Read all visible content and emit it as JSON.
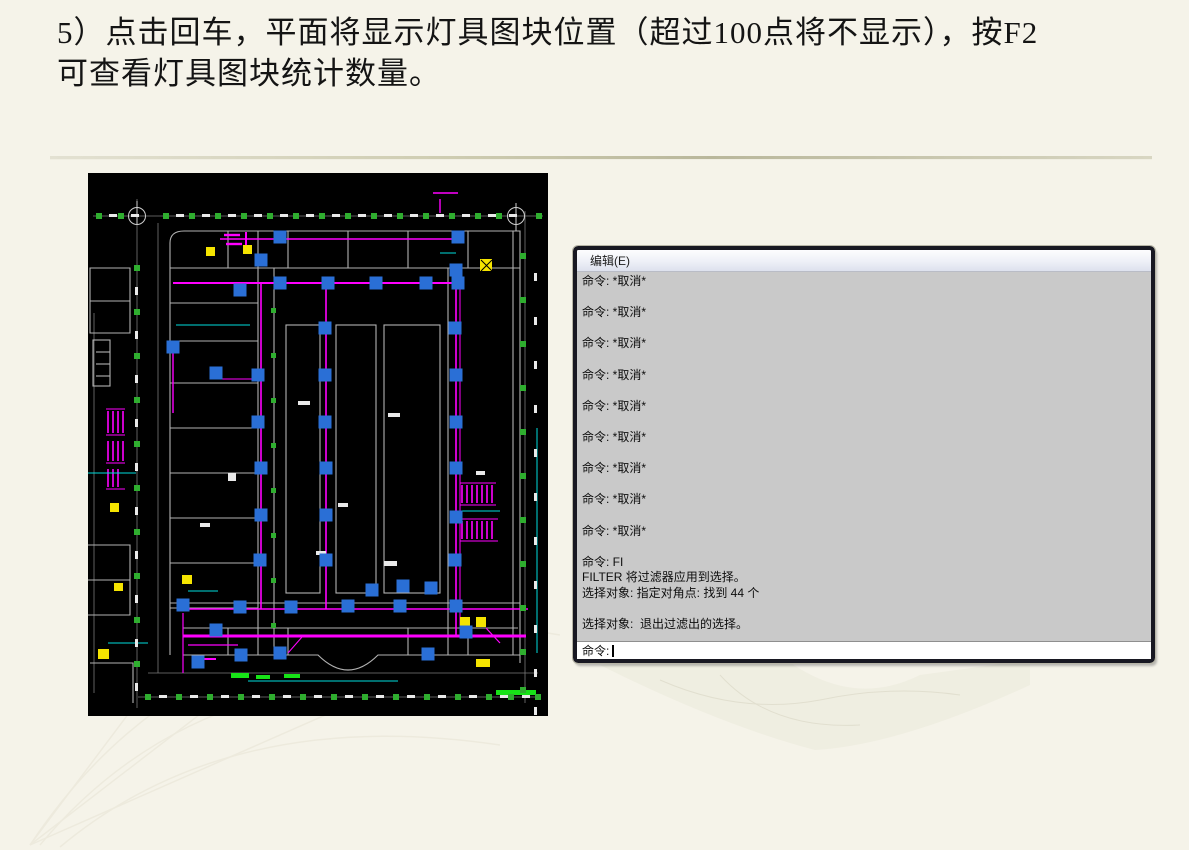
{
  "slide": {
    "title_line1": "5）点击回车，平面将显示灯具图块位置（超过100点将不显示），按F2",
    "title_line2": "可查看灯具图块统计数量。"
  },
  "command_window": {
    "menu_edit": "编辑(E)",
    "history_lines": [
      "命令: *取消*",
      "",
      "命令: *取消*",
      "",
      "命令: *取消*",
      "",
      "命令: *取消*",
      "",
      "命令: *取消*",
      "",
      "命令: *取消*",
      "",
      "命令: *取消*",
      "",
      "命令: *取消*",
      "",
      "命令: *取消*",
      "",
      "命令: FI",
      "FILTER 将过滤器应用到选择。",
      "选择对象: 指定对角点: 找到 44 个",
      "",
      "选择对象:  退出过滤出的选择。",
      ""
    ],
    "prompt": "命令:",
    "found_count": "44"
  },
  "cad": {
    "colors": {
      "background": "#000000",
      "wall": "#b2b2b2",
      "wall_dim": "#6e6e6e",
      "wiring": "#ff00ff",
      "lamp": "#2a6fd6",
      "tick_green": "#2fae2f",
      "bright_green": "#17e317",
      "cyan": "#00dddd",
      "yellow": "#f5e400",
      "white": "#e9e9e9"
    },
    "lamp_size": 13,
    "lamp_blocks": [
      [
        192,
        64
      ],
      [
        370,
        64
      ],
      [
        173,
        87
      ],
      [
        152,
        117
      ],
      [
        192,
        110
      ],
      [
        240,
        110
      ],
      [
        288,
        110
      ],
      [
        338,
        110
      ],
      [
        368,
        97
      ],
      [
        370,
        110
      ],
      [
        85,
        174
      ],
      [
        237,
        155
      ],
      [
        367,
        155
      ],
      [
        128,
        200
      ],
      [
        170,
        202
      ],
      [
        237,
        202
      ],
      [
        368,
        202
      ],
      [
        170,
        249
      ],
      [
        237,
        249
      ],
      [
        368,
        249
      ],
      [
        173,
        295
      ],
      [
        238,
        295
      ],
      [
        368,
        295
      ],
      [
        173,
        342
      ],
      [
        238,
        342
      ],
      [
        368,
        344
      ],
      [
        172,
        387
      ],
      [
        238,
        387
      ],
      [
        367,
        387
      ],
      [
        315,
        413
      ],
      [
        343,
        415
      ],
      [
        284,
        417
      ],
      [
        95,
        432
      ],
      [
        152,
        434
      ],
      [
        203,
        434
      ],
      [
        260,
        433
      ],
      [
        312,
        433
      ],
      [
        368,
        433
      ],
      [
        128,
        457
      ],
      [
        378,
        459
      ],
      [
        110,
        489
      ],
      [
        153,
        482
      ],
      [
        192,
        480
      ],
      [
        340,
        481
      ]
    ],
    "ticks": {
      "top": {
        "y": 40,
        "xs": [
          8,
          30,
          75,
          101,
          127,
          153,
          179,
          205,
          231,
          257,
          283,
          309,
          335,
          361,
          387,
          408,
          448
        ]
      },
      "bottom": {
        "y": 521,
        "xs": [
          57,
          88,
          119,
          150,
          181,
          212,
          243,
          274,
          305,
          336,
          367,
          398,
          420,
          447
        ]
      },
      "left": {
        "x": 46,
        "ys": [
          92,
          136,
          180,
          224,
          268,
          312,
          356,
          400,
          444,
          488
        ]
      },
      "right": {
        "x": 432,
        "ys": [
          80,
          124,
          168,
          212,
          256,
          300,
          344,
          388,
          432,
          476,
          514
        ]
      },
      "corridor": {
        "x": 183,
        "ys": [
          135,
          180,
          225,
          270,
          315,
          360,
          405,
          450
        ]
      }
    }
  }
}
